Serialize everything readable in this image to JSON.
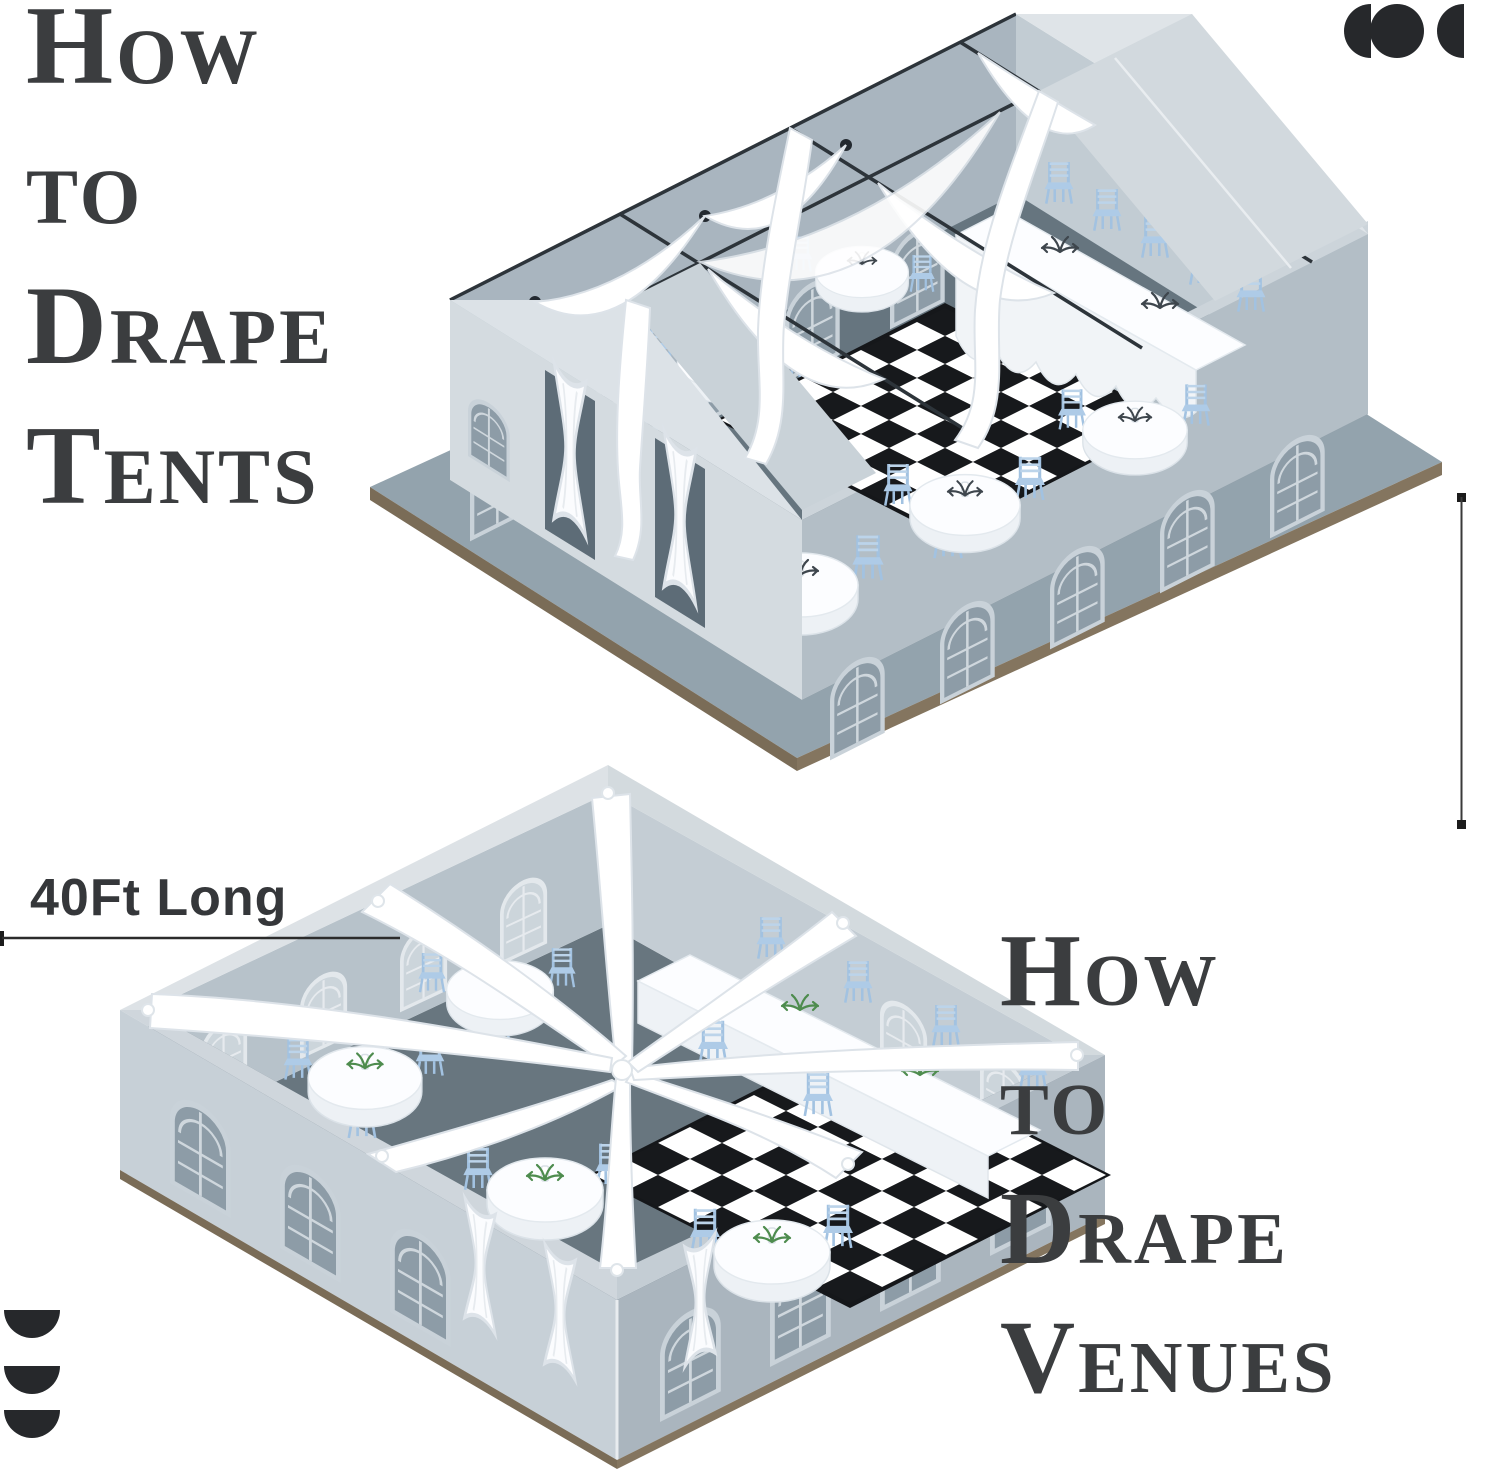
{
  "page": {
    "background": "#ffffff"
  },
  "titles": {
    "tents": {
      "lines": [
        "How",
        "to",
        "Drape",
        "Tents"
      ]
    },
    "venues": {
      "lines": [
        "How",
        "to",
        "Drape",
        "Venues"
      ]
    }
  },
  "measurement": {
    "horizontal_label": "40Ft Long"
  },
  "icons": {
    "top_right": "circle-and-semicircles-icon",
    "bottom_left": "stacked-semicircles-icon"
  },
  "colors": {
    "title_text": "#3b3d3f",
    "measure_text": "#35373a",
    "measure_line": "#2e2e2e",
    "icon": "#26282b",
    "tent_wall": "#aab6c0",
    "tent_floor": "#66757f",
    "roof_light": "#d7dde2",
    "drape_white": "#ffffff",
    "chair_blue": "#aecbe7",
    "checker_black": "#17191c",
    "platform_edge": "#7a6c57",
    "greenery": "#4e8c4e"
  }
}
